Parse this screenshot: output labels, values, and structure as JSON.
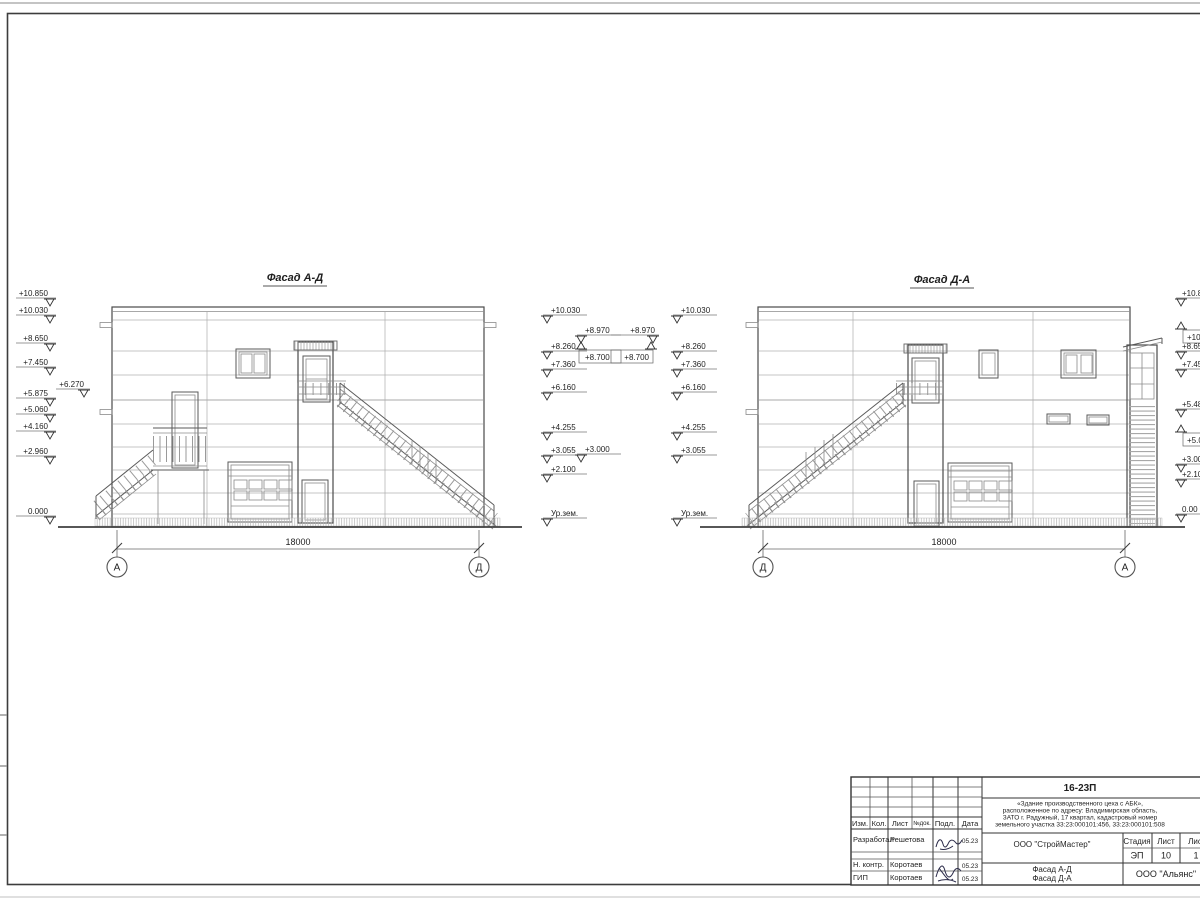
{
  "titles": {
    "left": "Фасад А-Д",
    "right": "Фасад Д-А"
  },
  "dims": {
    "left": "18000",
    "right": "18000"
  },
  "axes": {
    "la": "А",
    "lb": "Д",
    "ra": "Д",
    "rb": "А"
  },
  "ground_label": "Ур.зем.",
  "elev": {
    "l1": [
      "+10.850",
      "+10.030",
      "+8.650",
      "+7.450",
      "+5.875",
      "+5.060",
      "+4.160",
      "+2.960",
      "0.000"
    ],
    "l1x": "+6.270",
    "m1": [
      "+10.030",
      "+8.260",
      "+7.360",
      "+6.160",
      "+4.255",
      "+3.055",
      "+2.100",
      "Ур.зем."
    ],
    "c": {
      "t1": "+8.970",
      "b1": "+8.700",
      "t2": "+8.970",
      "b2": "+8.700",
      "m": "+3.000"
    },
    "m2": [
      "+10.030",
      "+8.260",
      "+7.360",
      "+6.160",
      "+4.255",
      "+3.055",
      "Ур.зем."
    ],
    "r1": [
      "+10.8",
      "+10.0",
      "+8.65",
      "+7.45",
      "+5.48",
      "+5.08",
      "+3.00",
      "+2.10",
      "0.00"
    ]
  },
  "tb": {
    "code": "16-23П",
    "desc": [
      "«Здание производственного цеха с АБК»,",
      "расположенное по адресу: Владимирская область,",
      "ЗАТО г. Радужный, 17 квартал, кадастровый номер",
      "земельного участка 33:23:000101:456, 33:23:000101:508"
    ],
    "cols": {
      "izm": "Изм.",
      "kol": "Кол.",
      "list": "Лист",
      "ndoc": "№док.",
      "podp": "Подл.",
      "data": "Дата"
    },
    "rows": [
      {
        "role": "Разработал",
        "name": "Решетова",
        "date": "05.23"
      },
      {
        "role": "Н. контр.",
        "name": "Коротаев",
        "date": "05.23"
      },
      {
        "role": "ГИП",
        "name": "Коротаев",
        "date": "05.23"
      }
    ],
    "org": "ООО \"СтройМастер\"",
    "stage_label": "Стадия",
    "sheet_label": "Лист",
    "sheets_label": "Лис",
    "stage": "ЭП",
    "sheet_no": "10",
    "sheets_total": "1",
    "title1": "Фасад А-Д",
    "title2": "Фасад Д-А",
    "contractor": "ООО \"Альянс\""
  }
}
